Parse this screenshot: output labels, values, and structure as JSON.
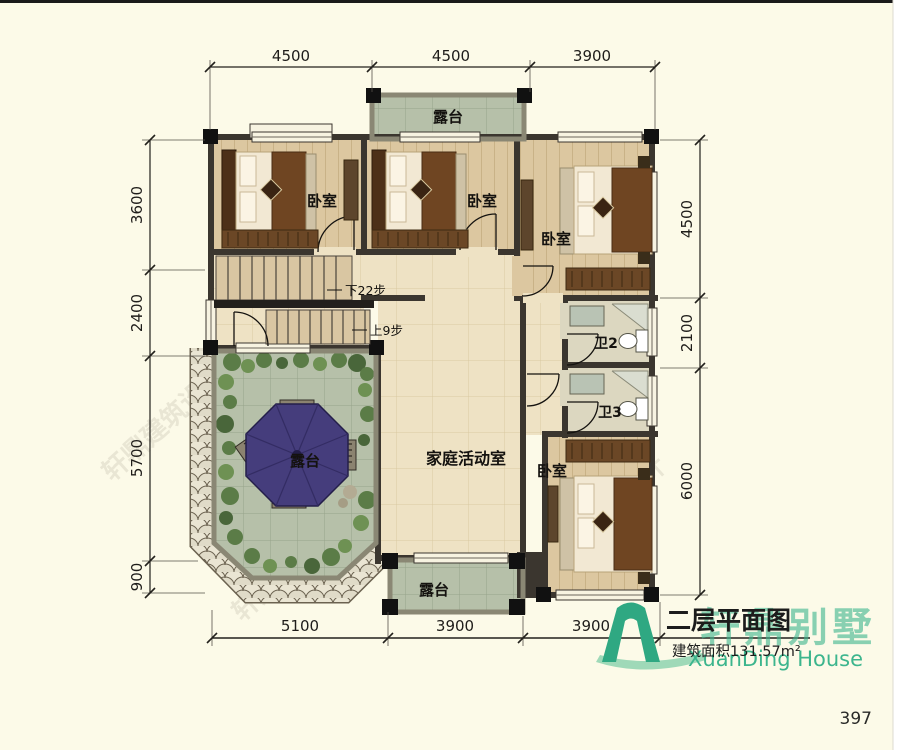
{
  "page": {
    "number": "397"
  },
  "watermark": {
    "text": "轩鼎建筑设计"
  },
  "title_block": {
    "title": "二层平面图",
    "area": "建筑面积131.57m²",
    "brand_cn": "轩鼎别墅",
    "brand_en": "XuanDing House"
  },
  "dimensions": {
    "top": [
      "4500",
      "4500",
      "3900"
    ],
    "bottom": [
      "5100",
      "3900",
      "3900"
    ],
    "left": [
      "3600",
      "2400",
      "5700",
      "900"
    ],
    "right": [
      "4500",
      "2100",
      "6000"
    ]
  },
  "rooms": {
    "bedroom": "卧室",
    "terrace": "露台",
    "family_room": "家庭活动室",
    "bath2": "卫2",
    "bath3": "卫3"
  },
  "stairs": {
    "down": "下22步",
    "up": "上9步"
  },
  "colors": {
    "background": "#fcfae8",
    "wall": "#3b362f",
    "terrace_tile": "#b6c0a9",
    "umbrella": "#453d7c",
    "brand_green": "#3cb58d"
  }
}
